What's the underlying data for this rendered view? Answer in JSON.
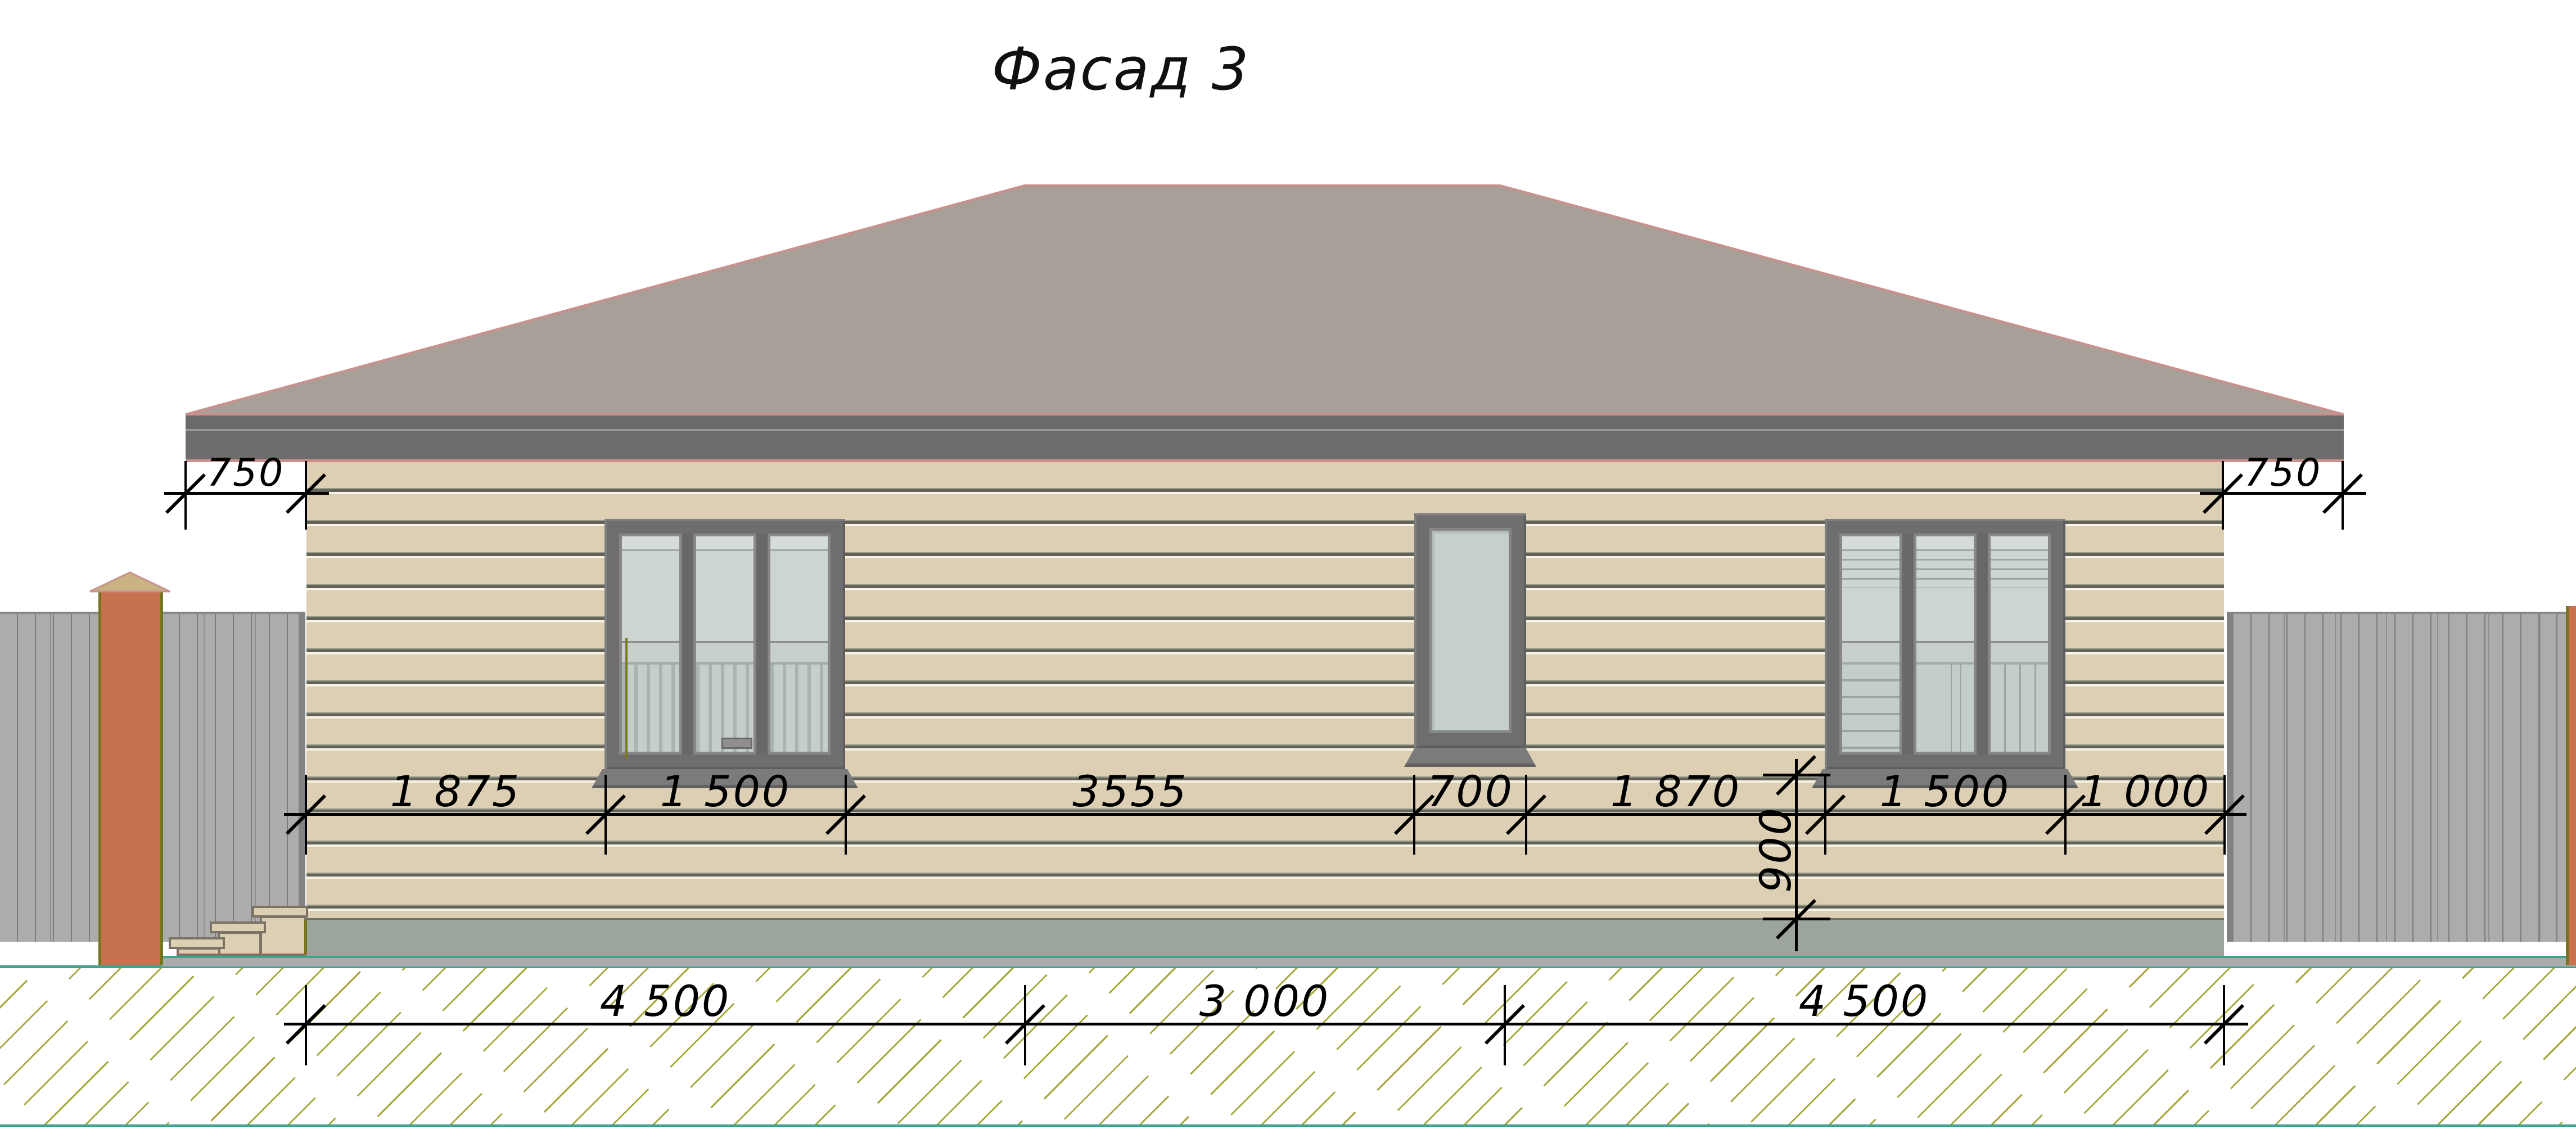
{
  "title": "Фасад 3",
  "dimensions": {
    "eave_left": "750",
    "eave_right": "750",
    "wall_segments": [
      "1 875",
      "1 500",
      "3555",
      "700",
      "1 870",
      "1 500",
      "1 000"
    ],
    "sill_height": "900",
    "foundation_segments": [
      "4 500",
      "3 000",
      "4 500"
    ]
  },
  "colors": {
    "roof": "#a89f99",
    "roof_outline": "#c9908c",
    "fascia": "#6a6a6a",
    "siding": "#dccfb4",
    "plinth": "#9ba49d",
    "window_frame": "#6e6e6e",
    "glass": "#c6cfcc",
    "fence": "#acacac",
    "brick_post": "#c7714f",
    "post_edge": "#75751f",
    "steps": "#dccfb3",
    "ground_line": "#3fa390",
    "hatch": "#a6a63a",
    "dimension_ink": "#000000"
  }
}
